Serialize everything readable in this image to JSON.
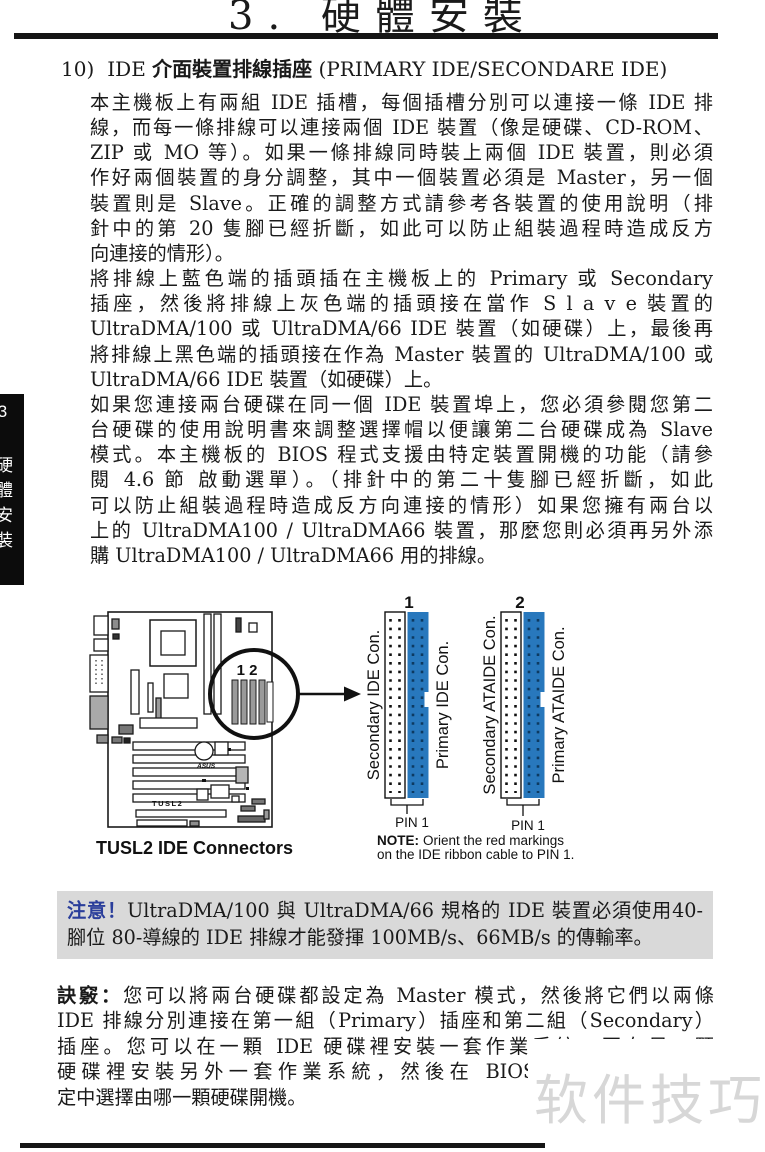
{
  "page": {
    "title": "3. 硬體安裝",
    "side_tab": "3 硬體安裝",
    "watermark": "软件技巧"
  },
  "section": {
    "number": "10)",
    "heading_pre": "IDE ",
    "heading_bold": "介面裝置排線插座",
    "heading_post": " (PRIMARY IDE/SECONDARE IDE)"
  },
  "paragraphs": {
    "p1": {
      "lines": [
        "本主機板上有兩組 IDE 插槽，每個插槽分別可以連接一條 IDE 排",
        "線，而每一條排線可以連接兩個 IDE 裝置（像是硬碟、CD-ROM、",
        "ZIP 或 MO 等）。如果一條排線同時裝上兩個 IDE 裝置，則必須",
        "作好兩個裝置的身分調整，其中一個裝置必須是 Master，另一個",
        "裝置則是 Slave。正確的調整方式請參考各裝置的使用說明（排",
        "針中的第 20 隻腳已經折斷，如此可以防止組裝過程時造成反方",
        "向連接的情形）。"
      ]
    },
    "p2": {
      "lines": [
        "將排線上藍色端的插頭插在主機板上的 Primary 或 Secondary",
        "插座，然後將排線上灰色端的插頭接在當作 S l a v e 裝置的",
        "UltraDMA/100 或 UltraDMA/66 IDE 裝置（如硬碟）上，最後再",
        "將排線上黑色端的插頭接在作為 Master 裝置的 UltraDMA/100 或",
        "UltraDMA/66 IDE 裝置（如硬碟）上。"
      ]
    },
    "p3": {
      "lines": [
        "如果您連接兩台硬碟在同一個 IDE 裝置埠上，您必須參閱您第二",
        "台硬碟的使用說明書來調整選擇帽以便讓第二台硬碟成為 Slave",
        "模式。本主機板的 BIOS 程式支援由特定裝置開機的功能（請參",
        "閱 4.6 節 啟動選單）。（排針中的第二十隻腳已經折斷，如此",
        "可以防止組裝過程時造成反方向連接的情形）如果您擁有兩台以",
        "上的 UltraDMA100 / UltraDMA66 裝置，那麼您則必須再另外添",
        "購 UltraDMA100 / UltraDMA66 用的排線。"
      ]
    }
  },
  "figure": {
    "board": {
      "caption": "TUSL2 IDE Connectors",
      "magnifier_label": "1 2",
      "board_label": "TUSL2",
      "logo": "ASUS"
    },
    "connectors": {
      "group1": {
        "number": "1",
        "left_label": "Secondary IDE Con.",
        "right_label": "Primary IDE Con.",
        "pin_label": "PIN 1"
      },
      "group2": {
        "number": "2",
        "left_label": "Secondary ATAIDE Con.",
        "right_label": "Primary ATAIDE Con.",
        "pin_label": "PIN 1"
      }
    },
    "note": {
      "bold": "NOTE:",
      "line1": "Orient the red markings",
      "line2": "on the IDE ribbon cable to PIN 1."
    },
    "colors": {
      "connector_blue": "#2878bd",
      "connector_pin_dark": "#0d3a61"
    }
  },
  "notice": {
    "label": "注意！",
    "line1": "UltraDMA/100 與 UltraDMA/66 規格的 IDE 裝置必須使用40-",
    "line2": "腳位 80-導線的 IDE 排線才能發揮 100MB/s、66MB/s 的傳輸率。"
  },
  "tip": {
    "label": "訣竅：",
    "lines": [
      "您可以將兩台硬碟都設定為 Master 模式，然後將它們以兩條",
      "IDE 排線分別連接在第一組（Primary）插座和第二組（Secondary）",
      "插座。您可以在一顆 IDE 硬碟裡安裝一套作業系統，再在另一顆",
      "硬碟裡安裝另外一套作業系統，然後在 BIOS 程式中的開機設",
      "定中選擇由哪一顆硬碟開機。"
    ]
  }
}
